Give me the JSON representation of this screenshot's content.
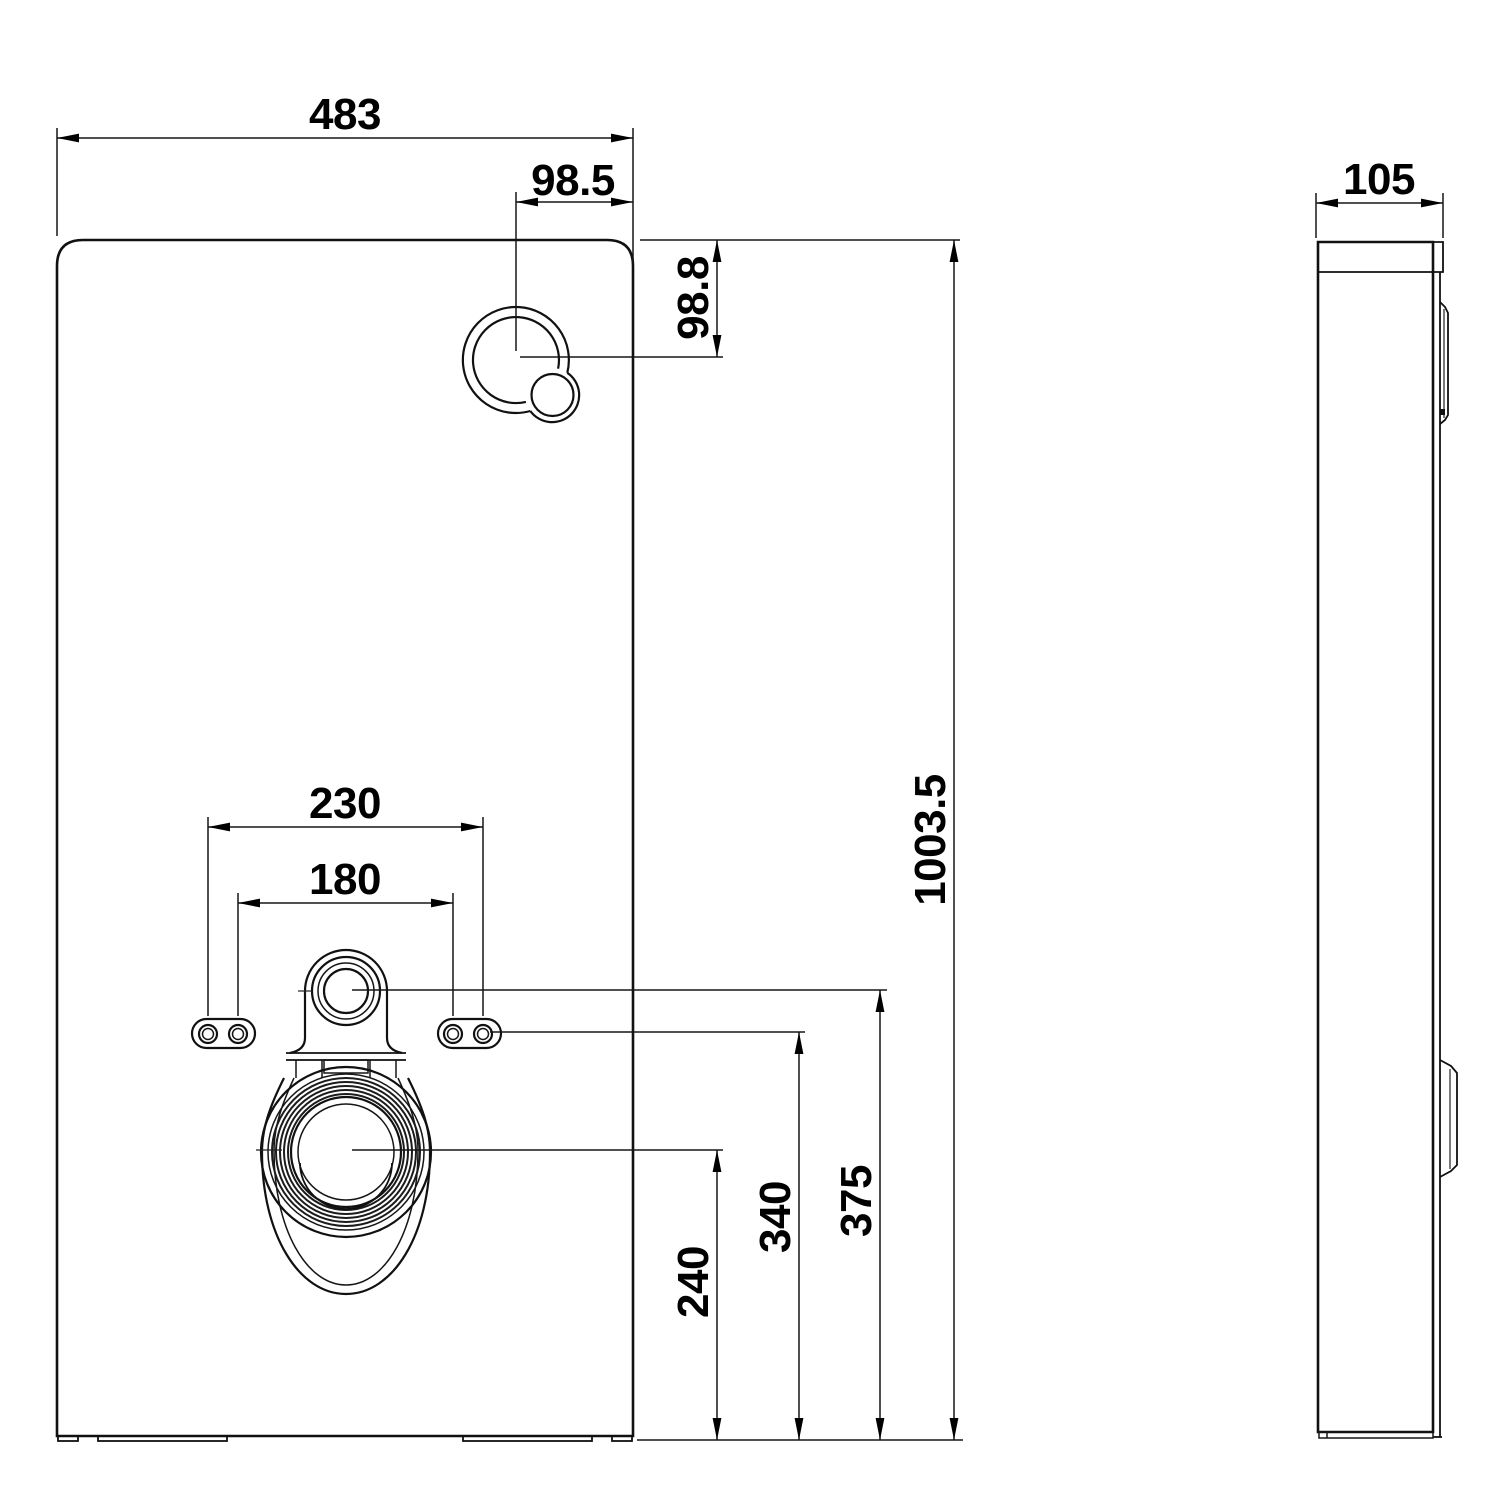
{
  "drawing": {
    "type": "technical-installation-drawing",
    "views": {
      "front": "sanitary-module-front-view",
      "side": "sanitary-module-side-view"
    }
  },
  "dims": {
    "overall_width": "483",
    "button_offset_x": "98.5",
    "button_offset_y": "98.8",
    "fixing_span_outer": "230",
    "fixing_span_inner": "180",
    "overall_height": "1003.5",
    "outlet_center_height": "240",
    "fixing_holes_height": "340",
    "inlet_center_height": "375",
    "depth": "105"
  }
}
